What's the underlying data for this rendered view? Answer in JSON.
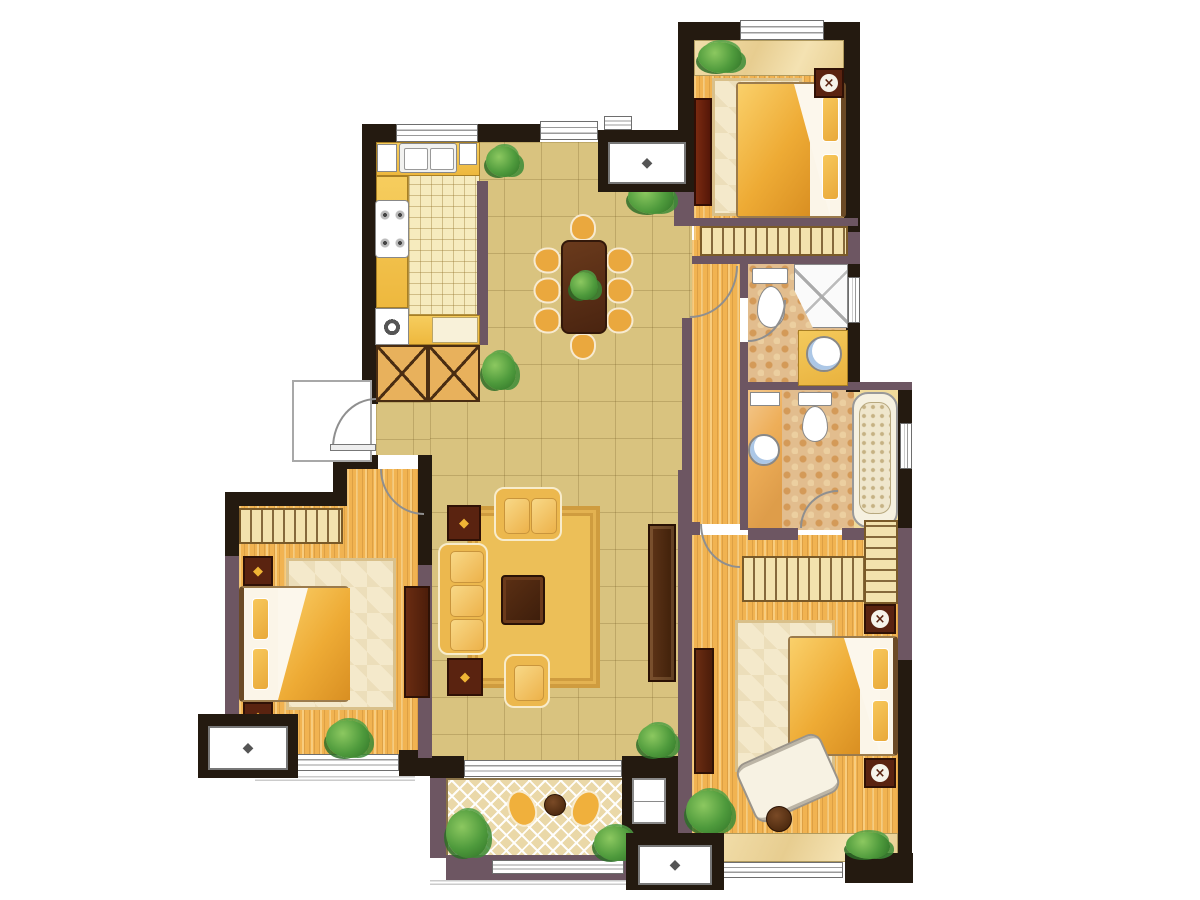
{
  "plan": {
    "kind": "residential-apartment-floor-plan",
    "canvas": {
      "width": 1200,
      "height": 900
    },
    "glyphs": {
      "ac_unit": "◆",
      "lamp": "×",
      "lamp_star": "◆"
    },
    "palette": {
      "wall_exterior": "#241a10",
      "wall_partition": "#6d5662",
      "floor_hall_tile": "#d9c37f",
      "floor_wood": "#f1b351",
      "floor_kitchen_tile": "#f6ebbe",
      "floor_bath_mosaic": "#e2bd8e",
      "floor_balcony": "#ead8a8",
      "counter_gold": "#f3c24b",
      "furniture_gold": "#ecb84e",
      "furniture_dark_wood": "#4c2410",
      "fixture_white": "#ffffff",
      "plant_green": "#4e9a3c"
    },
    "rooms": [
      {
        "name": "kitchen",
        "features": [
          "l-counter",
          "double-sink",
          "small-appliance",
          "cooktop-4-burner",
          "washing-machine",
          "prep-board",
          "checker-tile-floor",
          "window"
        ]
      },
      {
        "name": "dining-room",
        "features": [
          "dining-table",
          "eight-chairs",
          "centerpiece-plant",
          "window",
          "plants"
        ]
      },
      {
        "name": "bedroom-top-right",
        "features": [
          "double-bed",
          "nightstand-lamp",
          "tall-dresser",
          "wardrobe-hangers",
          "bay-shelf-plant",
          "window"
        ]
      },
      {
        "name": "hallway-corridor",
        "features": [
          "wood-floor",
          "doors"
        ]
      },
      {
        "name": "bathroom-1",
        "features": [
          "toilet",
          "corner-shower",
          "round-sink-vanity",
          "mosaic-floor",
          "window"
        ]
      },
      {
        "name": "bathroom-2",
        "features": [
          "toilet",
          "round-sink",
          "bathtub",
          "mosaic-floor",
          "window"
        ]
      },
      {
        "name": "living-room",
        "features": [
          "three-seat-sofa",
          "two-armchairs",
          "coffee-table",
          "area-rug",
          "lamp-side-tables",
          "tv-cabinet",
          "balcony-door"
        ]
      },
      {
        "name": "bedroom-bottom-left",
        "features": [
          "double-bed",
          "two-nightstands",
          "wardrobe-hangers",
          "dresser",
          "rug",
          "window",
          "plant"
        ]
      },
      {
        "name": "master-bedroom",
        "features": [
          "double-bed",
          "two-nightstand-lamps",
          "l-wardrobe-hangers",
          "lounge-chair",
          "side-table",
          "cabinet",
          "bay-window",
          "plants"
        ]
      },
      {
        "name": "balcony",
        "features": [
          "herringbone-floor",
          "two-chairs",
          "round-table",
          "storage-cabinet",
          "plants",
          "railing"
        ]
      }
    ],
    "equipment": [
      {
        "name": "ac-outdoor-unit-top"
      },
      {
        "name": "ac-outdoor-unit-bottom-left"
      },
      {
        "name": "ac-outdoor-unit-bottom-right"
      }
    ],
    "doors": [
      {
        "name": "entry-door",
        "type": "swing"
      },
      {
        "name": "bedroom-bottom-left-door",
        "type": "swing"
      },
      {
        "name": "corridor-door",
        "type": "swing"
      },
      {
        "name": "bathroom-1-door",
        "type": "swing"
      },
      {
        "name": "bathroom-2-door",
        "type": "swing"
      },
      {
        "name": "master-bedroom-door",
        "type": "swing"
      },
      {
        "name": "balcony-door",
        "type": "sliding-window"
      }
    ]
  }
}
